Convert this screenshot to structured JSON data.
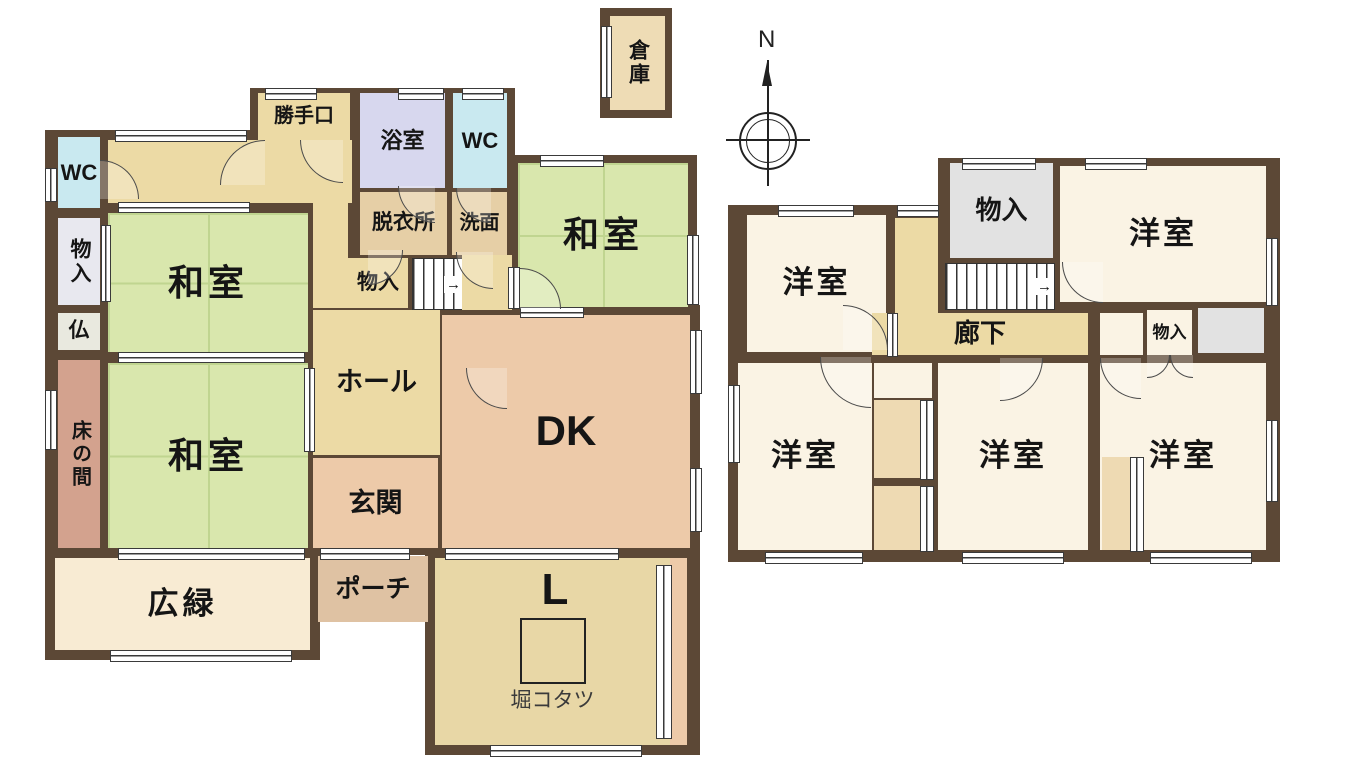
{
  "compass": {
    "north": "N"
  },
  "stairs": {
    "up_arrow": "→"
  },
  "floor1": {
    "kura": "倉庫",
    "wc_left": "WC",
    "storage_left": "物入",
    "butsuma": "仏",
    "tokonoma": "床の間",
    "washitsu_top": "和室",
    "washitsu_bottom": "和室",
    "washitsu_right": "和室",
    "katteguchi": "勝手口",
    "bathroom": "浴室",
    "wc_top": "WC",
    "datsuijo": "脱衣所",
    "senmen": "洗面",
    "storage_hall": "物入",
    "hall": "ホール",
    "genkan": "玄関",
    "porch": "ポーチ",
    "hiroen": "広緑",
    "dk": "DK",
    "living": "L",
    "kotatsu": "堀コタツ"
  },
  "floor2": {
    "yoshitsu_tl": "洋室",
    "yoshitsu_tr": "洋室",
    "yoshitsu_bl": "洋室",
    "yoshitsu_bc": "洋室",
    "yoshitsu_br": "洋室",
    "storage_top": "物入",
    "storage_small": "物入",
    "corridor": "廊下"
  },
  "colors": {
    "wall": "#5c4836",
    "washitsu": "#d9e7ad",
    "tatamiline": "#c0d590",
    "hall": "#ecdaa5",
    "tan2": "#e6cfa6",
    "cream": "#f8ebd3",
    "peach": "#edcaa9",
    "pinkroom": "#d3a28e",
    "lavender": "#d7d7ee",
    "lightblue": "#c9e9f0",
    "graylav": "#e8e8ef",
    "butsu": "#e9e9df",
    "ivory": "#faf3e4",
    "gray2f": "#e2e2e2",
    "closet": "#eedab3",
    "porchc": "#dfc2a3",
    "ltan": "#e8d7a6",
    "kura": "#eedcb5"
  }
}
